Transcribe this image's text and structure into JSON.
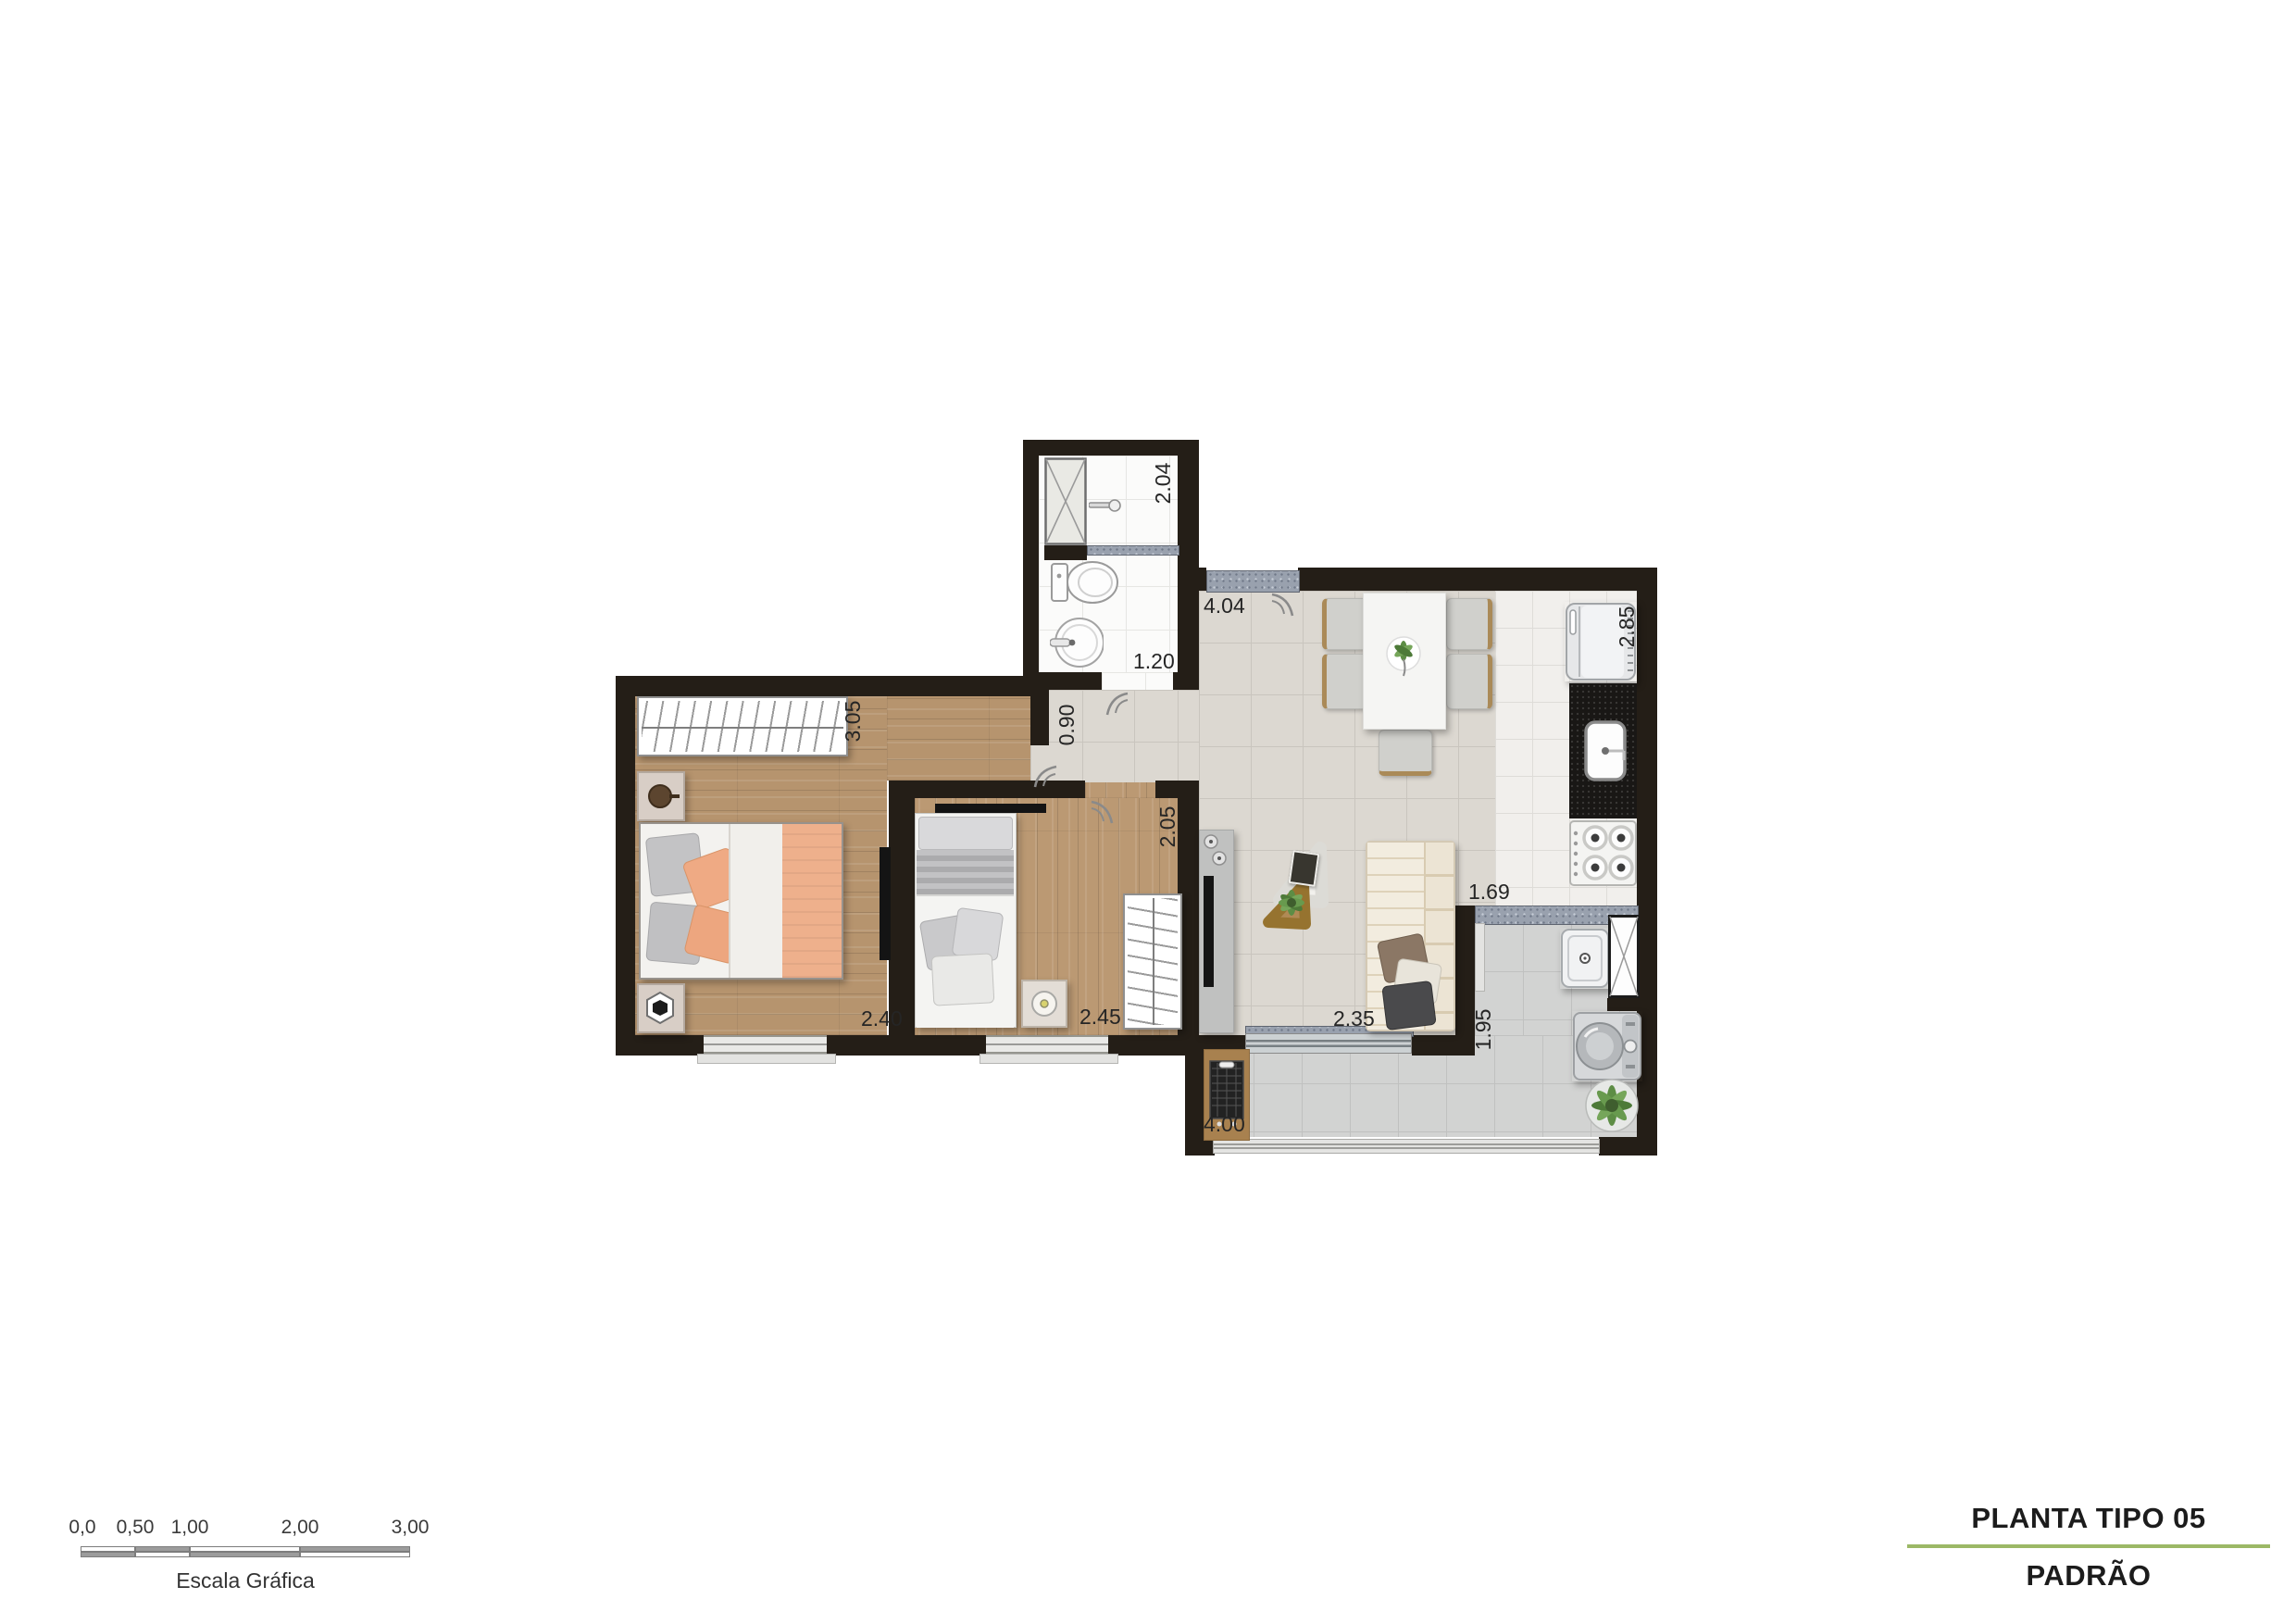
{
  "document": {
    "type_label": "PLANTA TIPO 05",
    "variant_label": "PADRÃO"
  },
  "scale_bar": {
    "labels": [
      "0,0",
      "0,50",
      "1,00",
      "2,00",
      "3,00"
    ],
    "caption": "Escala Gráfica"
  },
  "dimensions": {
    "bathroom_depth": "2.04",
    "bathroom_width": "1.20",
    "hall_opening": "0.90",
    "living_dining_width": "4.04",
    "kitchen_depth": "2.85",
    "bedroom1_depth": "3.05",
    "bedroom1_width": "2.40",
    "bedroom2_depth": "2.05",
    "bedroom2_width": "2.45",
    "living_length": "2.35",
    "service_width": "1.69",
    "service_depth": "1.95",
    "balcony_length": "4.00"
  },
  "colors": {
    "accent_green": "#9cb866",
    "wall": "#241e17",
    "wood_floor": "#b6946e",
    "ceramic_beige": "#dcd8d1",
    "balcony_gray": "#d2d3d2",
    "granite_sill": "#99a1ae",
    "blanket_salmon": "#eeb08c"
  }
}
